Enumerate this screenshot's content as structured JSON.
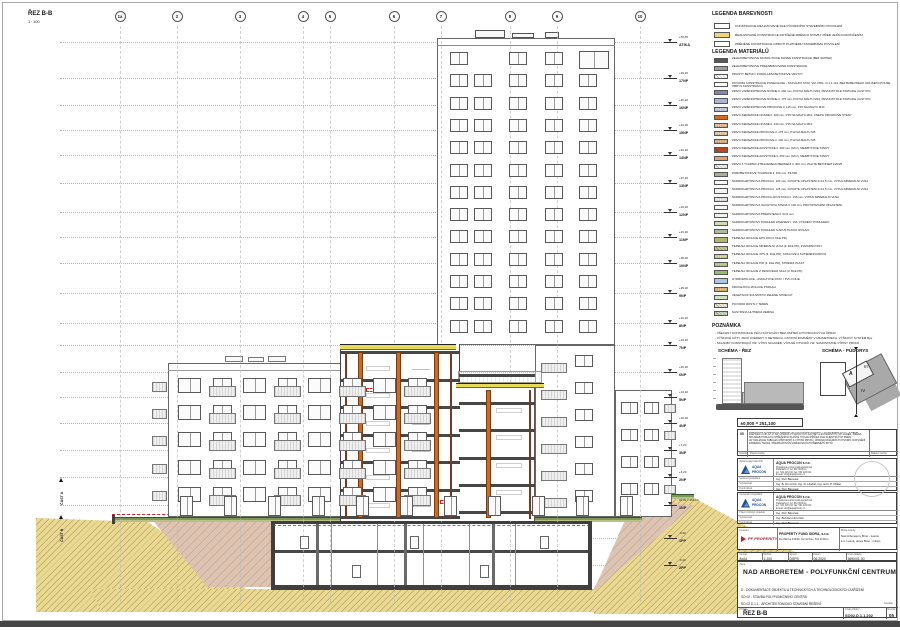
{
  "sheet": {
    "title": "ŘEZ B-B",
    "scale": "1 : 100",
    "part_labels": [
      "ČÁST A",
      "ČÁST B"
    ]
  },
  "grid": {
    "bubbles": [
      {
        "label": "1a",
        "x": 120
      },
      {
        "label": "2",
        "x": 177
      },
      {
        "label": "3",
        "x": 240
      },
      {
        "label": "4",
        "x": 303
      },
      {
        "label": "5",
        "x": 330
      },
      {
        "label": "6",
        "x": 394
      },
      {
        "label": "7",
        "x": 441
      },
      {
        "label": "8",
        "x": 510
      },
      {
        "label": "9",
        "x": 557
      },
      {
        "label": "10",
        "x": 640
      }
    ]
  },
  "levels": [
    {
      "label": "ATIKA",
      "elev": "+54,45",
      "y": 42
    },
    {
      "label": "17NP",
      "elev": "+49,20",
      "y": 78
    },
    {
      "label": "16NP",
      "elev": "+46,20",
      "y": 105
    },
    {
      "label": "15NP",
      "elev": "+43,20",
      "y": 130
    },
    {
      "label": "14NP",
      "elev": "+40,20",
      "y": 155
    },
    {
      "label": "13NP",
      "elev": "+37,20",
      "y": 183
    },
    {
      "label": "12NP",
      "elev": "+34,20",
      "y": 212
    },
    {
      "label": "11NP",
      "elev": "+31,20",
      "y": 237
    },
    {
      "label": "10NP",
      "elev": "+28,20",
      "y": 263
    },
    {
      "label": "9NP",
      "elev": "+25,20",
      "y": 293
    },
    {
      "label": "8NP",
      "elev": "+22,20",
      "y": 323
    },
    {
      "label": "7NP",
      "elev": "+19,20",
      "y": 345
    },
    {
      "label": "6NP",
      "elev": "+16,20",
      "y": 372
    },
    {
      "label": "5NP",
      "elev": "+13,20",
      "y": 397
    },
    {
      "label": "4NP",
      "elev": "+10,20",
      "y": 423
    },
    {
      "label": "3NP",
      "elev": "+7,20",
      "y": 450
    },
    {
      "label": "2NP",
      "elev": "+4,20",
      "y": 477
    },
    {
      "label": "1NP",
      "elev": "±0,00 = 251,10",
      "y": 505
    },
    {
      "label": "1PP",
      "elev": "-3,40",
      "y": 538
    },
    {
      "label": "2PP",
      "elev": "-6,40",
      "y": 565
    }
  ],
  "legend_colors": {
    "heading": "LEGENDA BAREVNOSTI",
    "items": [
      {
        "t": "KONSTRUKCE REALIZOVANÉ DLE PŮVODNÍHO STAVEBNÍHO POVOLENÍ",
        "c": "#ffffff",
        "p": "solid"
      },
      {
        "t": "REALIZOVANÉ KONSTRUKCE DOTČENÉ ZMĚNOU STAVBY PŘED JEJÍM DOKONČENÍM",
        "c": "#f2d478",
        "p": "solid"
      },
      {
        "t": "ZMĚNĚNÉ KONSTRUKCE OPROTI PLATNÉMU STAVEBNÍMU POVOLENÍ",
        "c": "#ffffff",
        "p": "solid"
      }
    ]
  },
  "legend_materials": {
    "heading": "LEGENDA MATERIÁLŮ",
    "items": [
      {
        "t": "ŽELEZOBETONOVÉ MONOLITICKÉ NOSNÉ KONSTRUKCE (BEZ OMÍTEK)",
        "c": "#595959",
        "p": "solid"
      },
      {
        "t": "ŽELEZOBETONOVÉ PREFABRIKOVANÉ KONSTRUKCE",
        "c": "#9d9d9d",
        "p": "solid"
      },
      {
        "t": "PROSTÝ BETON / PODKLADNÍ BETONOVÉ VRSTVY",
        "c": "#ffffff",
        "p": "hatch"
      },
      {
        "t": "PŮVODNÍ KONSTRUKCE PONECHANÉ - STÁVAJÍCÍ STAV, VIZ. PŘÍL. D.1.1.101, BEZ BAREVNÉHO ODLIŠENÍ (POUZE OBRYS KONSTRUKCÍ)",
        "c": "#ffffff",
        "p": "solid"
      },
      {
        "t": "ZDIVO VÁPENOPÍSKOVÉ NOSNÉ tl. 240 mm, P20 NA MALTU M10, PEVNOST DLE STATICKÉ ČÁSTI PD",
        "c": "#7f88ba",
        "p": "solid"
      },
      {
        "t": "ZDIVO VÁPENOPÍSKOVÉ NOSNÉ tl. 175 mm, P20 NA MALTU M10, PEVNOST DLE STATICKÉ ČÁSTI PD",
        "c": "#aab3d1",
        "p": "solid"
      },
      {
        "t": "ZDIVO VÁPENOPÍSKOVÉ PŘÍČKOVÉ tl. 115 mm, P15 NA MALTU M10",
        "c": "#d3d5ec",
        "p": "dots"
      },
      {
        "t": "ZDIVO KERAMICKÉ NOSNÉ tl. 300 mm, P15 NA MALTU M10, VNĚJŠÍ OBVODOVÉ STĚNY",
        "c": "#d2691e",
        "p": "solid"
      },
      {
        "t": "ZDIVO KERAMICKÉ NOSNÉ tl. 240 mm, P15 NA MALTU M10",
        "c": "#ecc9a8",
        "p": "dots"
      },
      {
        "t": "ZDIVO KERAMICKÉ PŘÍČKOVÉ tl. 175 mm, P10 NA MALTU M5",
        "c": "#ecd4b2",
        "p": "dots"
      },
      {
        "t": "ZDIVO KERAMICKÉ PŘÍČKOVÉ tl. 140 mm, P10 NA MALTU M5",
        "c": "#e6bd92",
        "p": "dots"
      },
      {
        "t": "ZDIVO KERAMICKÉ AKUSTICKÉ tl. 300 mm (AKU), MEZIBYTOVÉ STĚNY",
        "c": "#c04a28",
        "p": "hatch"
      },
      {
        "t": "ZDIVO KERAMICKÉ AKUSTICKÉ tl. 250 mm (AKU), MEZIBYTOVÉ STĚNY",
        "c": "#e89e6e",
        "p": "solid"
      },
      {
        "t": "ZDIVO Z TVÁRNIC ZTRACENÉHO BEDNĚNÍ tl. 300 mm, ZALITÉ BETONEM C20/25",
        "c": "#f3f3f3",
        "p": "hatch"
      },
      {
        "t": "PÓROBETONOVÉ TVÁRNICE tl. 150 mm, P4-500",
        "c": "#a4b097",
        "p": "solid"
      },
      {
        "t": "SÁDROKARTONOVÁ PŘÍČKA tl. 100 mm, DVOJITÉ OPLÁŠTĚNÍ 2×12,5 mm, VÝPLŇ MINERÁLNÍ VLNA",
        "c": "#fbfbfb",
        "p": "solid"
      },
      {
        "t": "SÁDROKARTONOVÁ PŘÍČKA tl. 125 mm, DVOJITÉ OPLÁŠTĚNÍ 2×12,5 mm, VÝPLŇ MINERÁLNÍ VLNA",
        "c": "#f4f4f4",
        "p": "solid"
      },
      {
        "t": "SÁDROKARTONOVÁ PŘÍČKA AKUSTICKÁ tl. 155 mm, VÝPLŇ MINERÁLNÍ VLNA",
        "c": "#f4f4f4",
        "p": "dots"
      },
      {
        "t": "SÁDROKARTONOVÁ ŠACHTOVÁ STĚNA tl. 100 mm, PROTIPOŽÁRNÍ OPLÁŠTĚNÍ",
        "c": "#f7f7f7",
        "p": "solid"
      },
      {
        "t": "SÁDROKARTONOVÁ PŘEDSTĚNA tl. 62,5 mm",
        "c": "#eef2e8",
        "p": "solid"
      },
      {
        "t": "SÁDROKARTONOVÝ PODHLED ZAVĚŠENÝ, VIZ. VÝKRESY PODHLEDŮ",
        "c": "#cdddb5",
        "p": "solid"
      },
      {
        "t": "SÁDROKARTONOVÝ PODHLED S AKUSTICKOU IZOLACÍ",
        "c": "#aeb9a2",
        "p": "solid"
      },
      {
        "t": "TEPELNÁ IZOLACE EPS 100 (tl. DLE PD)",
        "c": "#b2b76d",
        "p": "solid"
      },
      {
        "t": "TEPELNÁ IZOLACE MINERÁLNÍ VLNA (tl. DLE PD), POŽÁRNÍ PÁSY",
        "c": "#cbcb7c",
        "p": "hatch"
      },
      {
        "t": "TEPELNÁ IZOLACE XPS (tl. DLE PD), SOKLOVÉ A SUTERÉNNÍ ZDIVO",
        "c": "#dfe3a3",
        "p": "dots"
      },
      {
        "t": "TEPELNÁ IZOLACE PIR (tl. DLE PD), STŘEŠNÍ PLÁŠŤ",
        "c": "#c4da8f",
        "p": "dots"
      },
      {
        "t": "TEPELNÁ IZOLACE Z PĚNOVÉHO SKLA (tl. DLE PD)",
        "c": "#90c264",
        "p": "solid"
      },
      {
        "t": "HYDROIZOLACE - ASFALTOVÉ PÁSY / PVC FÓLIE",
        "c": "#a9c8e3",
        "p": "solid"
      },
      {
        "t": "KROČEJOVÁ IZOLACE PODLAH",
        "c": "#e9c280",
        "p": "dots"
      },
      {
        "t": "VEGETAČNÍ SOUVRSTVÍ ZELENÉ STŘECHY",
        "c": "#d3e2c2",
        "p": "solid"
      },
      {
        "t": "PŮVODNÍ ROSTLÝ TERÉN",
        "c": "#ece9d8",
        "p": "hatch"
      },
      {
        "t": "NASYPANÁ HUTNĚNÁ ZEMINA",
        "c": "#ccd6b8",
        "p": "hatch"
      }
    ]
  },
  "notes": {
    "heading": "POZNÁMKA",
    "lines": [
      "- VŠECHNY KONSTRUKCE JSOU KÓTOVÁNY BEZ OMÍTEK A POVRCHOVÝCH ÚPRAV",
      "- VÝŠKOVÉ KÓTY JSOU UVEDENY V METRECH, OSTATNÍ ROZMĚRY V MILIMETRECH, VÝŠKOVÝ SYSTÉM Bpv",
      "- SKLADBY KONSTRUKCÍ VIZ. VÝPIS SKLADEB, VÝPLNĚ OTVORŮ VIZ. SAMOSTATNÉ VÝPISY PRVKŮ"
    ]
  },
  "schemes": {
    "section_title": "SCHÉMA - ŘEZ",
    "plan_title": "SCHÉMA - PŮDORYS",
    "plan_labels": [
      "A",
      "III",
      "IV"
    ]
  },
  "datum": {
    "text": "±0,000 = 251,100"
  },
  "revision": {
    "code": "05",
    "text": "ZMĚNA DLE POŽADAVKŮ PŘEDANÝCH 31.03.2020 PROPERTY FUND SIDRA S.R.O. - ZMĚNA DISPOZIC 2.NP AŽ 17.NP, ÚPRAVA VÝTAHOVÝCH ŠACHET A SCHODIŠŤOVÝCH JADER, ZMĚNA SKLADEB PODLAH A STŘEŠNÍHO PLÁŠTĚ, POSUN PŘÍČEK DLE KLIENTSKÝCH ZMĚN, AKTUALIZACE TABULEK MÍSTNOSTÍ A VÝPISŮ PRVKŮ, ÚPRAVA FASÁDNÍCH OTVORŮ, DOPLNĚNÍ ZÁBRADLÍ TERAS, PŘEPRACOVÁNÍ ZAŘIZOVACÍCH PŘEDMĚTŮ BYTŮ",
    "footer": [
      "Revize",
      "Popis revize",
      "Datum revize"
    ]
  },
  "brand": {
    "aqua": [
      "AQUA",
      "PROCON"
    ]
  },
  "firms": [
    {
      "role_label": "Zpracovatel části PD",
      "company": "AQUA PROCON s.r.o.",
      "company_lines": [
        "Projektová a inženýrská společnost",
        "Palackého tř. 12, 612 00 Brno",
        "tel.: 541 426 011, fax: 541 426 012",
        "E-mail: info@aquaprocon.cz"
      ],
      "rows": [
        [
          "Vedoucí projektant",
          "Ing. Petr Baranek"
        ],
        [
          "Vypracoval",
          "Ing. B. Hrnczirik, Ing. R. Hrabal, Ing. arch. P. Müller"
        ],
        [
          "Kontroloval",
          "Ing. Petr Baranek"
        ]
      ]
    },
    {
      "role_label": "Generální projektant",
      "company": "AQUA PROCON s.r.o.",
      "company_lines": [
        "Projektová a inženýrská společnost",
        "Palackého tř. 12, 612 00 Brno",
        "tel.: 541 426 011, fax: 541 426 012",
        "E-mail: info@aquaprocon.cz"
      ],
      "rows": [
        [
          "Hlavní inženýr projektu",
          "Ing. Petr Baranek"
        ],
        [
          "Vypracoval",
          "Ing. Bohdan Hrnczirik"
        ],
        [
          "Kontroloval",
          "Ing. Petr Baranek"
        ]
      ]
    }
  ],
  "investor": {
    "label": "Investor",
    "logo": "PF PROPERITY",
    "name": "PROPERTY FUND SIDRA, s.r.o.",
    "addr": "Durďákova 336/29, Černá Pole, 613 00 Brno",
    "site_label": "Místo stavby",
    "site_lines": [
      "Nad Arboretem, Brno - Lesná",
      "k.ú. Lesná, okres Brno - město"
    ]
  },
  "params": [
    {
      "label": "Formát",
      "value": "8xA4"
    },
    {
      "label": "Měřítko",
      "value": "1:100"
    },
    {
      "label": "Stupeň",
      "value": "DSPS"
    },
    {
      "label": "Datum",
      "value": "06.2020"
    },
    {
      "label": "Číslo zakázky",
      "value": "3690/01.00"
    }
  ],
  "titleblock": {
    "akce_label": "Akce",
    "project": "NAD ARBORETEM - POLYFUNKČNÍ CENTRUM",
    "lines": [
      "D - DOKUMENTACE OBJEKTU A TECHNICKÝCH A TECHNOLOGICKÝCH ZAŘÍZENÍ",
      "SO 02 - STAVBA POLYFUNKČNÍHO CENTRA",
      "SO 02.D.1.1 - ARCHITEKTONICKO STAVEBNÍ ŘEŠENÍ"
    ],
    "soutisk": "Soutisk",
    "priloha_label": "Příloha",
    "drawing_title": "ŘEZ B-B",
    "number_label": "Číslo přílohy",
    "drawing_number": "SO02.D.1.1.202",
    "revision_label": "Revize",
    "revision": "05"
  }
}
